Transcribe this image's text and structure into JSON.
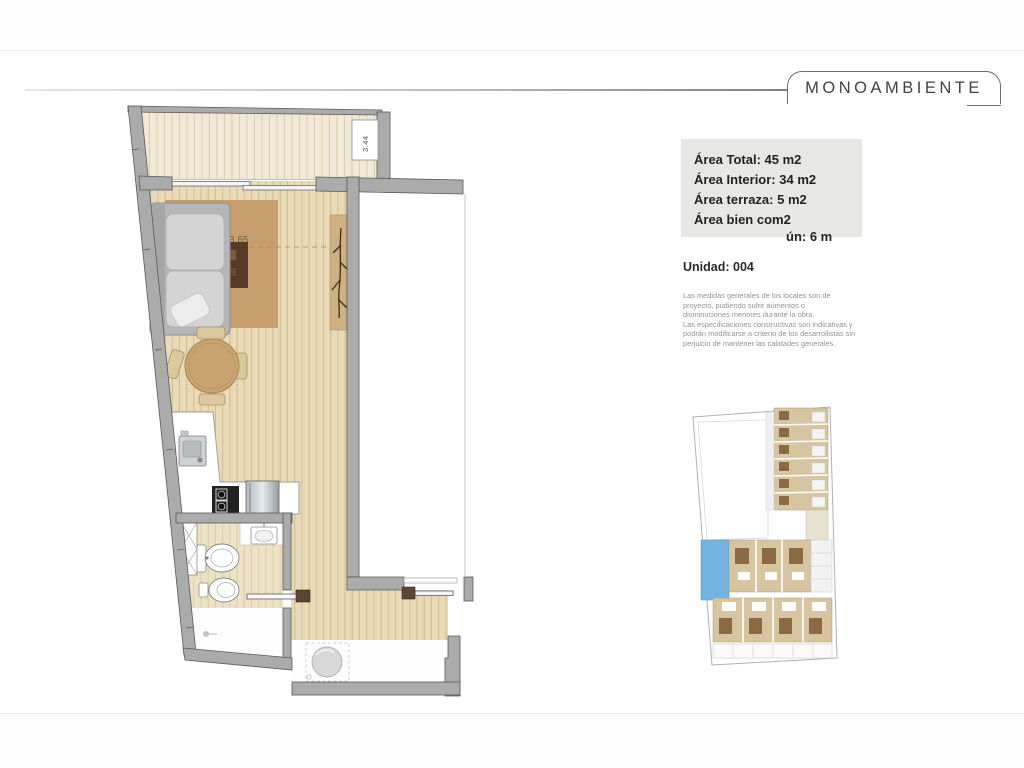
{
  "header": {
    "title": "MONOAMBIENTE"
  },
  "info_box": {
    "line1": "Área Total: 45 m2",
    "line2": "Área Interior: 34 m2",
    "line3": "Área terraza: 5 m2",
    "line4": "Área bien com2",
    "line5": "ún: 6 m"
  },
  "unit": {
    "label": "Unidad: 004"
  },
  "disclaimer": {
    "lines": [
      "Las medidas generales de los locales son de",
      "proyecto, pudiendo sufrir aumentos o",
      "disminuciones menores durante la obra.",
      "Las especificaciones constructivas son indicativas y",
      "podrán modificarse a criterio de los desarrollistas sin",
      "perjuicio de mantener las calidades generales."
    ]
  },
  "plan": {
    "room_width_label": "3.65",
    "terrace_label": "3.44"
  },
  "colors": {
    "wood_floor": "#e9dab8",
    "deck_floor": "#f1e9d7",
    "rug": "#c79d6e",
    "coffee_table": "#573b26",
    "wall": "#ababab",
    "pool": "#74b3dd",
    "site_units": "#d7c5a2",
    "info_box_bg": "#e7e7e5"
  }
}
